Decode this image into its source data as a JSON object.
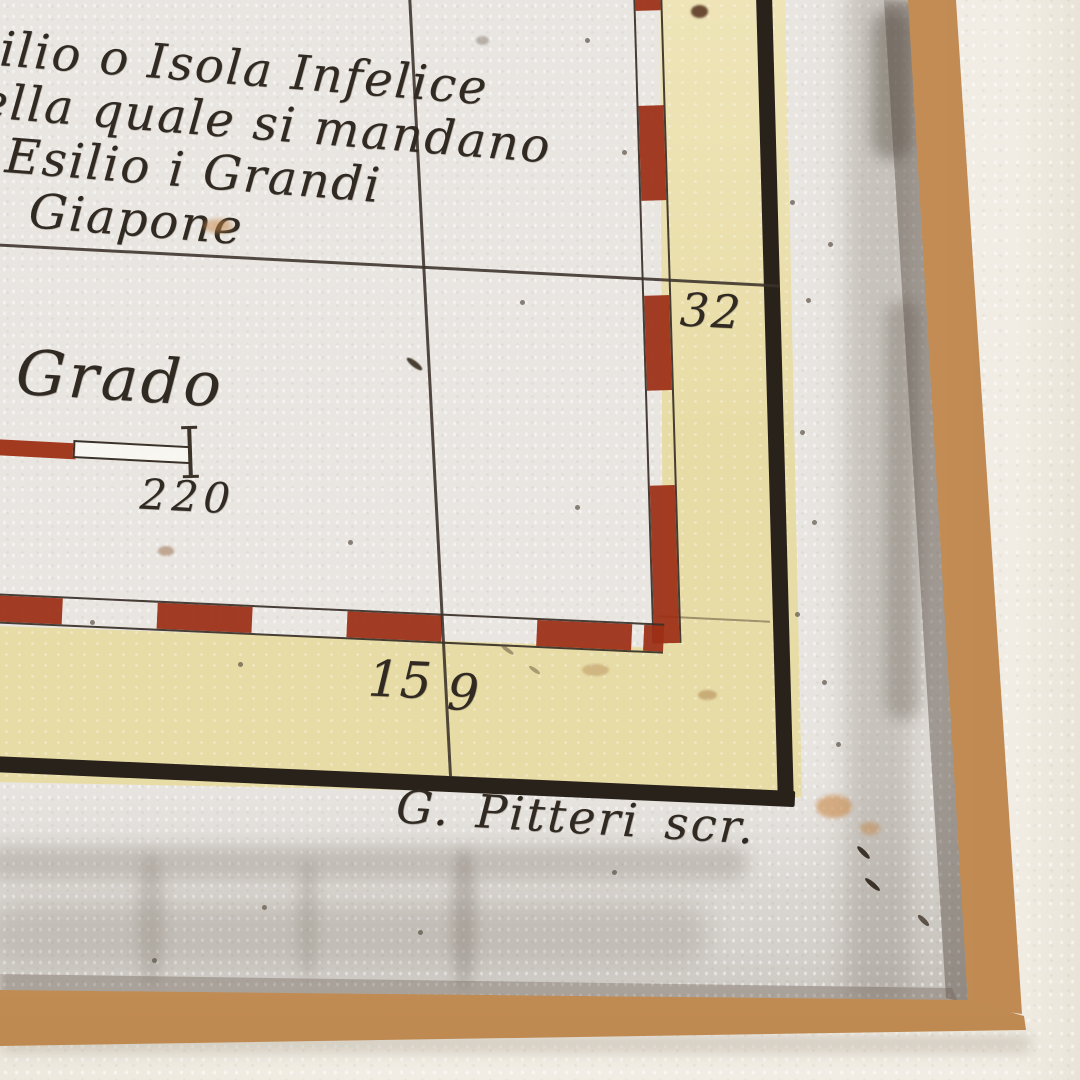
{
  "map": {
    "note_lines": [
      "ilio o Isola Infelice",
      "ella quale si mandano",
      "Esilio i Grandi",
      "Giapone"
    ],
    "scale_label": "Grado",
    "scale_number": "220",
    "latitude_label": "32",
    "longitude_label_left": "15",
    "longitude_label_right": "9",
    "engraver_credit": "G. Pitteri scr."
  },
  "colors": {
    "paper": "#e9e6e2",
    "margin_band_yellow": "#e8dca6",
    "dash_red": "#9d2f16",
    "ink": "#33291f",
    "frame_wood": "#d09b64",
    "wall": "#f1ede4"
  }
}
